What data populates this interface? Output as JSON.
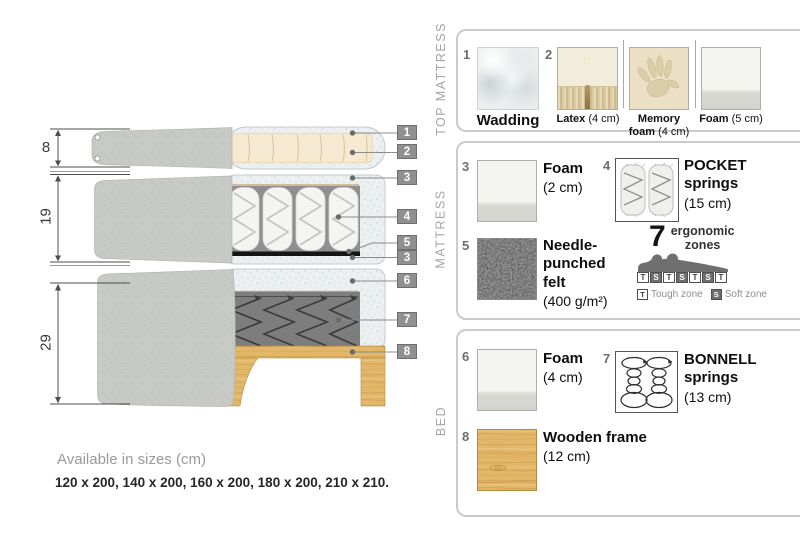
{
  "diagram": {
    "dims": [
      "8",
      "19",
      "29"
    ],
    "callouts": [
      "1",
      "2",
      "3",
      "4",
      "5",
      "3",
      "6",
      "7",
      "8"
    ],
    "sizes_title": "Available in sizes (cm)",
    "sizes_values": "120 x 200, 140 x 200, 160 x 200, 180 x 200, 210 x 210."
  },
  "legend": {
    "top_mattress": {
      "label": "TOP MATTRESS",
      "items": [
        {
          "num": "1",
          "name": "Wadding",
          "detail": ""
        },
        {
          "num": "2",
          "name": "Latex",
          "detail": "(4 cm)"
        },
        {
          "num": "",
          "name": "Memory foam",
          "detail": "(4 cm)"
        },
        {
          "num": "",
          "name": "Foam",
          "detail": "(5 cm)"
        }
      ]
    },
    "mattress": {
      "label": "MATTRESS",
      "items": [
        {
          "num": "3",
          "name": "Foam",
          "detail": "(2 cm)"
        },
        {
          "num": "4",
          "name": "POCKET springs",
          "detail": "(15 cm)"
        },
        {
          "num": "5",
          "name": "Needle-punched felt",
          "detail": "(400 g/m²)"
        }
      ],
      "zones": {
        "count": "7",
        "line1": "ergonomic",
        "line2": "zones",
        "pattern": [
          "T",
          "S",
          "T",
          "S",
          "T",
          "S",
          "T"
        ],
        "t_key": "T",
        "t_label": "Tough zone",
        "s_key": "S",
        "s_label": "Soft zone"
      }
    },
    "bed": {
      "label": "BED",
      "items": [
        {
          "num": "6",
          "name": "Foam",
          "detail": "(4 cm)"
        },
        {
          "num": "7",
          "name": "BONNELL springs",
          "detail": "(13 cm)"
        },
        {
          "num": "8",
          "name": "Wooden frame",
          "detail": "(12 cm)"
        }
      ]
    },
    "colors": {
      "fabric_gray": "#c7c9c4",
      "wadding_speckle": "#edf0f1",
      "latex_cream": "#f6e9d2",
      "felt_black": "#141414",
      "wood": "#e3b76a",
      "callout_gray": "#909090",
      "bracket_gray": "#cbcbcb"
    }
  }
}
